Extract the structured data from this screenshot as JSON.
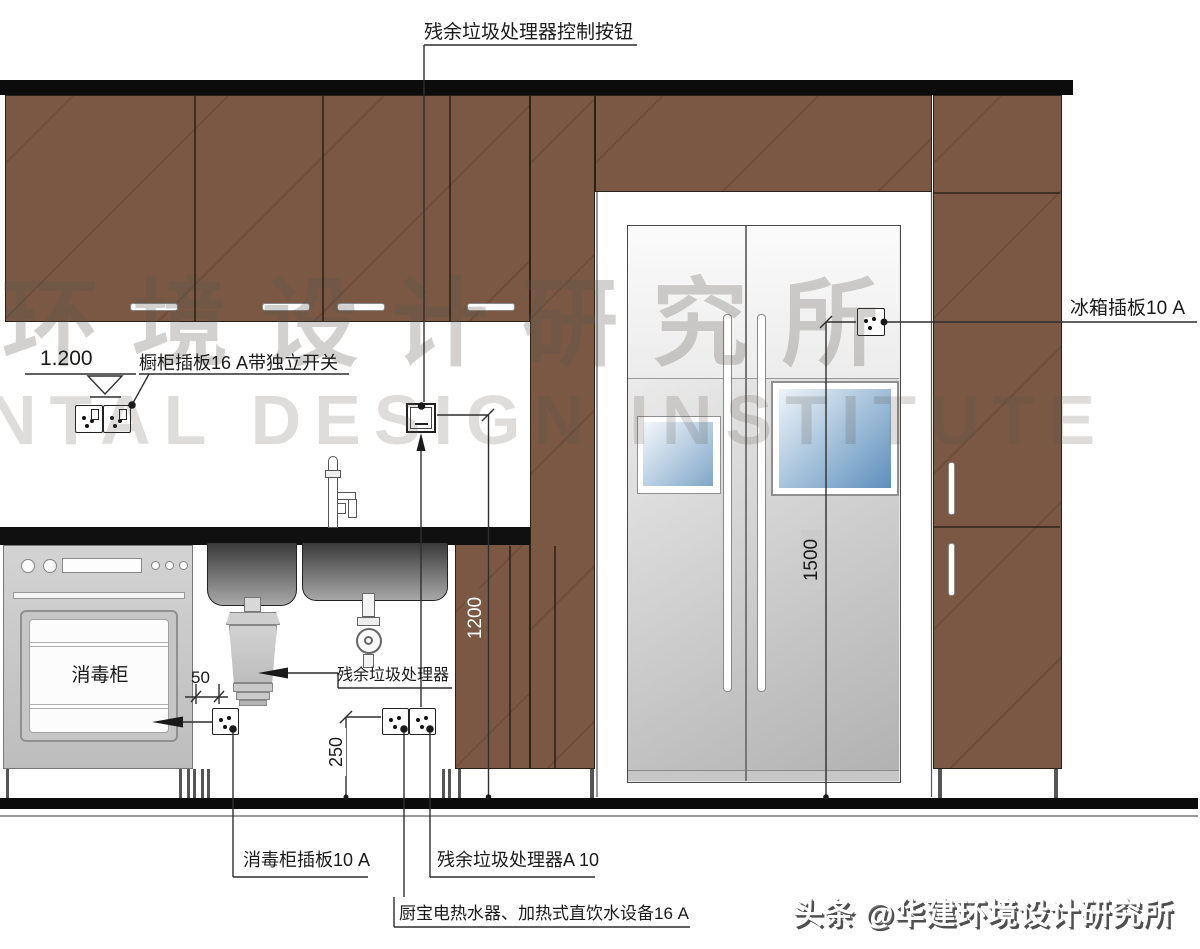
{
  "labels": {
    "control_button": "残余垃圾处理器控制按钮",
    "fridge_socket": "冰箱插板10 A",
    "elevation": "1.200",
    "counter_socket": "橱柜插板16 A带独立开关",
    "disposal": "残余垃圾处理器",
    "sterilizer_socket": "消毒柜插板10 A",
    "disposal_socket": "残余垃圾处理器A 10",
    "water_heater": "厨宝电热水器、加热式直饮水设备16 A"
  },
  "appliance": {
    "sterilizer": "消毒柜"
  },
  "dims": {
    "d50": "50",
    "d250": "250",
    "d1200": "1200",
    "d1500": "1500"
  },
  "watermark": {
    "cjk": "环境设计研究所",
    "latin": "NTAL DESIGN INSTITUTE"
  },
  "branding": "头条 @华建环境设计研究所",
  "colors": {
    "cabinet_brown": "#7a5843",
    "counter_black": "#101010",
    "line": "#2f2f2f",
    "window_blue": "#5d8fbc"
  }
}
